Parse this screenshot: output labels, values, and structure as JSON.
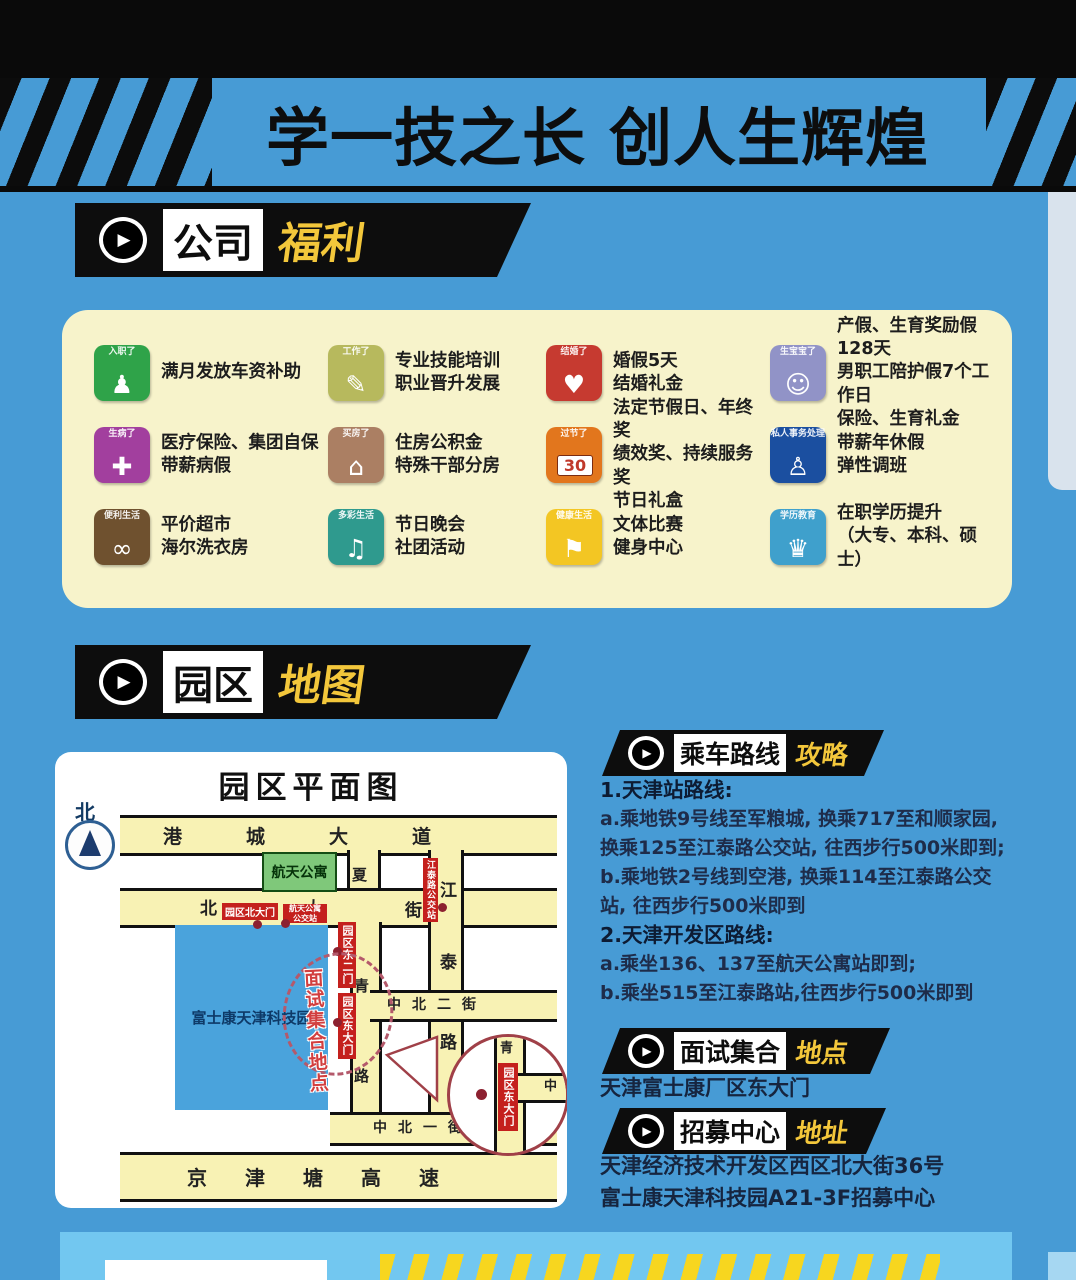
{
  "banner": {
    "title": "学一技之长 创人生辉煌"
  },
  "colors": {
    "background": "#479bd5",
    "banner_black": "#0d0d0d",
    "accent_yellow": "#f3c73b",
    "panel_cream": "#f7f3cb",
    "map_road_yellow": "#f8f2b4",
    "label_red": "#c4201d",
    "park_blue": "#4aa3dc",
    "apartment_green": "#7fc87a",
    "bottom_panel_blue": "#72c7f0"
  },
  "benefits": {
    "header": {
      "primary": "公司",
      "accent": "福利"
    },
    "items": [
      {
        "tag": "入职了",
        "icon": "walking-person-icon",
        "glyph": "♟",
        "color": "#2fa349",
        "text": "满月发放车资补助"
      },
      {
        "tag": "工作了",
        "icon": "office-worker-icon",
        "glyph": "✎",
        "color": "#b7b95d",
        "text": "专业技能培训\n职业晋升发展"
      },
      {
        "tag": "结婚了",
        "icon": "wedding-couple-icon",
        "glyph": "♥",
        "color": "#c63a30",
        "text": "婚假5天\n结婚礼金"
      },
      {
        "tag": "生宝宝了",
        "icon": "family-baby-icon",
        "glyph": "☺",
        "color": "#9193c7",
        "text": "产假、生育奖励假128天\n男职工陪护假7个工作日\n保险、生育礼金"
      },
      {
        "tag": "生病了",
        "icon": "medical-kit-icon",
        "glyph": "✚",
        "color": "#a23f9e",
        "text": "医疗保险、集团自保\n带薪病假"
      },
      {
        "tag": "买房了",
        "icon": "house-icon",
        "glyph": "⌂",
        "color": "#ab7f63",
        "text": "住房公积金\n特殊干部分房"
      },
      {
        "tag": "过节了",
        "icon": "calendar-30-icon",
        "glyph": "30",
        "color": "#e2761d",
        "text": "法定节假日、年终奖\n绩效奖、持续服务奖\n节日礼盒"
      },
      {
        "tag": "私人事务处理",
        "icon": "standing-person-icon",
        "glyph": "♙",
        "color": "#1b4fa0",
        "text": "带薪年休假\n弹性调班"
      },
      {
        "tag": "便利生活",
        "icon": "bicycle-icon",
        "glyph": "∞",
        "color": "#6f512f",
        "text": "平价超市\n海尔洗衣房"
      },
      {
        "tag": "多彩生活",
        "icon": "party-icon",
        "glyph": "♫",
        "color": "#2f9a8e",
        "text": "节日晚会\n社团活动"
      },
      {
        "tag": "健康生活",
        "icon": "runner-icon",
        "glyph": "⚑",
        "color": "#f3c623",
        "text": "文体比赛\n健身中心"
      },
      {
        "tag": "学历教育",
        "icon": "graduation-cap-icon",
        "glyph": "♛",
        "color": "#3fa0cc",
        "text": "在职学历提升\n（大专、本科、硕士）"
      }
    ]
  },
  "park_map": {
    "header": {
      "primary": "园区",
      "accent": "地图"
    },
    "title": "园区平面图",
    "north": "北",
    "roads": {
      "gangcheng_avenue": "港城大道",
      "beida_street": [
        "北",
        "大",
        "街"
      ],
      "xia": "夏",
      "qing": [
        "青",
        "路"
      ],
      "jiangtai_road": [
        "江",
        "泰",
        "路"
      ],
      "zhongbei_2nd": "中北二街",
      "zhongbei_1st": "中北一街",
      "expressway": "京津塘高速"
    },
    "blocks": {
      "apartment": "航天公寓",
      "park": "富士康天津科技园"
    },
    "labels": {
      "north_gate": "园区北大门",
      "apartment_stop": "航天公寓\n公交站",
      "jiangtai_stop": "江泰路公交站",
      "east_gate_2": "园区东二门",
      "east_gate": "园区东大门",
      "meeting_point": "面试集合地点"
    },
    "magnifier": {
      "gate": "园区东大门",
      "char_top": "青",
      "char_right": "中"
    }
  },
  "routes": {
    "header": {
      "primary": "乘车路线",
      "accent": "攻略"
    },
    "lines": [
      {
        "text": "1.天津站路线:",
        "heading": true
      },
      {
        "text": "a.乘地铁9号线至军粮城, 换乘717至和顺家园,",
        "heading": false
      },
      {
        "text": "换乘125至江泰路公交站, 往西步行500米即到;",
        "heading": false
      },
      {
        "text": "b.乘地铁2号线到空港, 换乘114至江泰路公交",
        "heading": false
      },
      {
        "text": "站, 往西步行500米即到",
        "heading": false
      },
      {
        "text": "2.天津开发区路线:",
        "heading": true
      },
      {
        "text": "a.乘坐136、137至航天公寓站即到;",
        "heading": false
      },
      {
        "text": "b.乘坐515至江泰路站,往西步行500米即到",
        "heading": false
      }
    ]
  },
  "meeting": {
    "header": {
      "primary": "面试集合",
      "accent": "地点"
    },
    "text": "天津富士康厂区东大门"
  },
  "recruit": {
    "header": {
      "primary": "招募中心",
      "accent": "地址"
    },
    "lines": "天津经济技术开发区西区北大街36号\n富士康天津科技园A21-3F招募中心"
  }
}
